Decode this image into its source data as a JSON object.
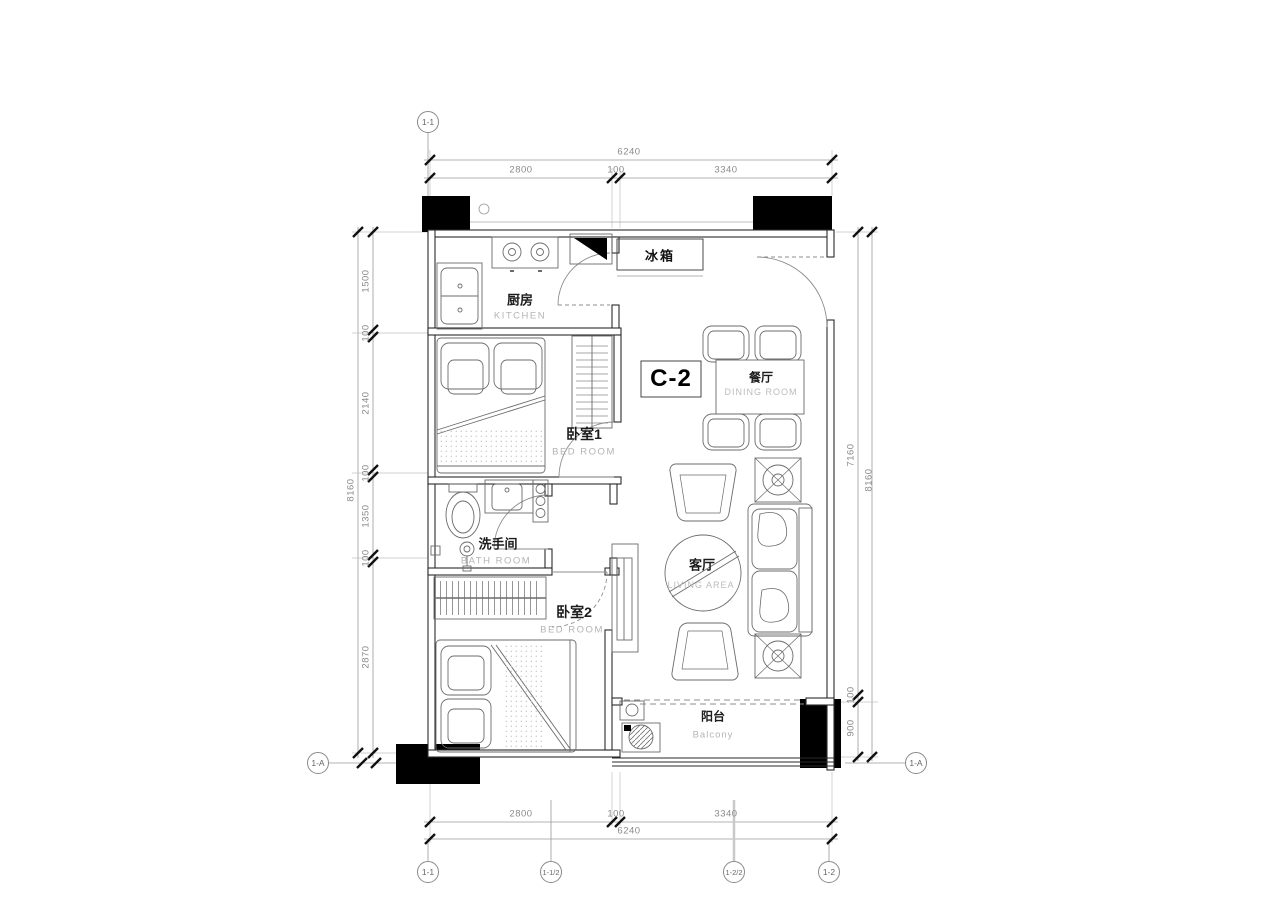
{
  "unit": {
    "label": "C-2"
  },
  "rooms": {
    "kitchen": {
      "cn": "厨房",
      "en": "KITCHEN"
    },
    "fridge": {
      "cn": "冰箱"
    },
    "dining": {
      "cn": "餐厅",
      "en": "DINING ROOM"
    },
    "bedroom1": {
      "cn": "卧室1",
      "en": "BED ROOM"
    },
    "bathroom": {
      "cn": "洗手间",
      "en": "BATH ROOM"
    },
    "bedroom2": {
      "cn": "卧室2",
      "en": "BED ROOM"
    },
    "living": {
      "cn": "客厅",
      "en": "LIVING AREA"
    },
    "balcony": {
      "cn": "阳台",
      "en": "Balcony"
    }
  },
  "dims": {
    "top": {
      "total": "6240",
      "segments": [
        "2800",
        "100",
        "3340"
      ]
    },
    "bottom": {
      "total": "6240",
      "segments": [
        "2800",
        "100",
        "3340"
      ]
    },
    "left": {
      "total": "8160",
      "segments": [
        "1500",
        "100",
        "2140",
        "100",
        "1350",
        "100",
        "2870"
      ]
    },
    "right": {
      "total": "8160",
      "segments": [
        "7160",
        "100",
        "900"
      ]
    }
  },
  "axes": {
    "top_left": "1-1",
    "left": "1-A",
    "right": "1-A",
    "bottom": [
      "1-1",
      "1-1/2",
      "1-2/2",
      "1-2"
    ]
  },
  "colors": {
    "wall": "#1a1a1a",
    "furniture": "#666666",
    "dimension": "#8a8a8a",
    "column": "#000000"
  }
}
